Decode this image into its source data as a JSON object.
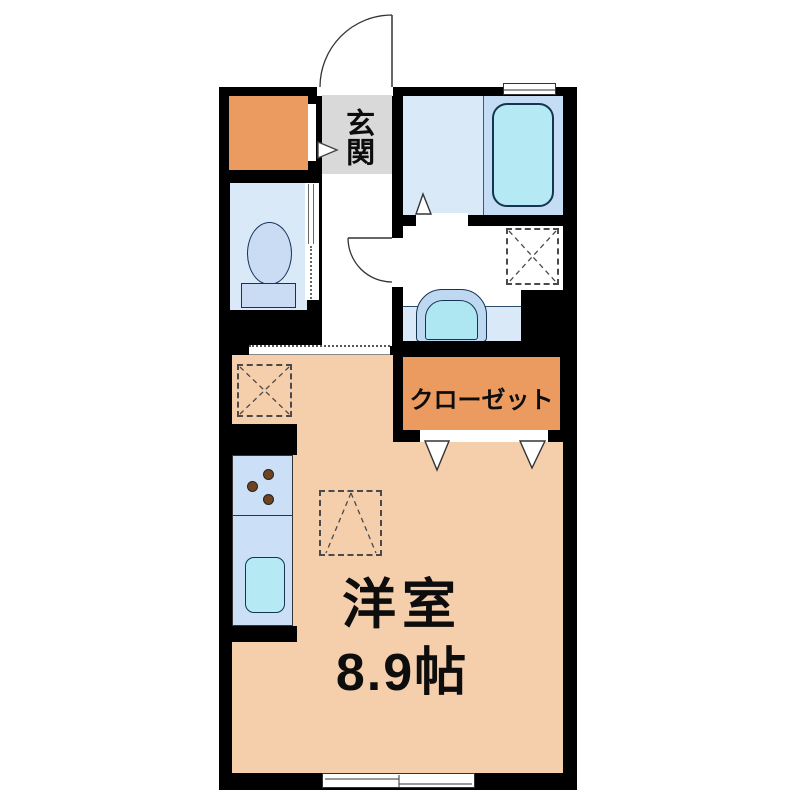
{
  "floorplan": {
    "labels": {
      "entrance": "玄関",
      "closet": "クローゼット",
      "room_name": "洋室",
      "room_size": "8.9帖"
    },
    "colors": {
      "wall": "#000000",
      "main_room_floor": "#F5CEAC",
      "closet": "#EC9B60",
      "storage": "#EC9B60",
      "entrance_floor": "#D9D9D9",
      "wet_area_floor": "#D9E9F8",
      "bath_zone": "#C5DDF4",
      "bathtub": "#B5E9F3",
      "fixture_blue": "#C9DCF4",
      "kitchen_counter": "#CBE0F6",
      "kitchen_sink": "#B5EAF4",
      "burner_brown": "#6F4320",
      "line": "#333333"
    },
    "features": {
      "entrance_door": "swing-door-arc",
      "washroom_door": "swing-door-arc",
      "toilet_door": "sliding-door",
      "main_room_door": "sliding-door-track",
      "closet_door": "folding-door-triangles",
      "bathroom_door": "folding-door-triangle",
      "washing_machine_space": "dashed-square-x",
      "appliance_space": "dashed-square-x",
      "loft_marker": "dashed-square-caret",
      "bathroom_window": "small-window",
      "main_room_window": "sliding-window",
      "entrance_direction": "arrow-right"
    }
  }
}
